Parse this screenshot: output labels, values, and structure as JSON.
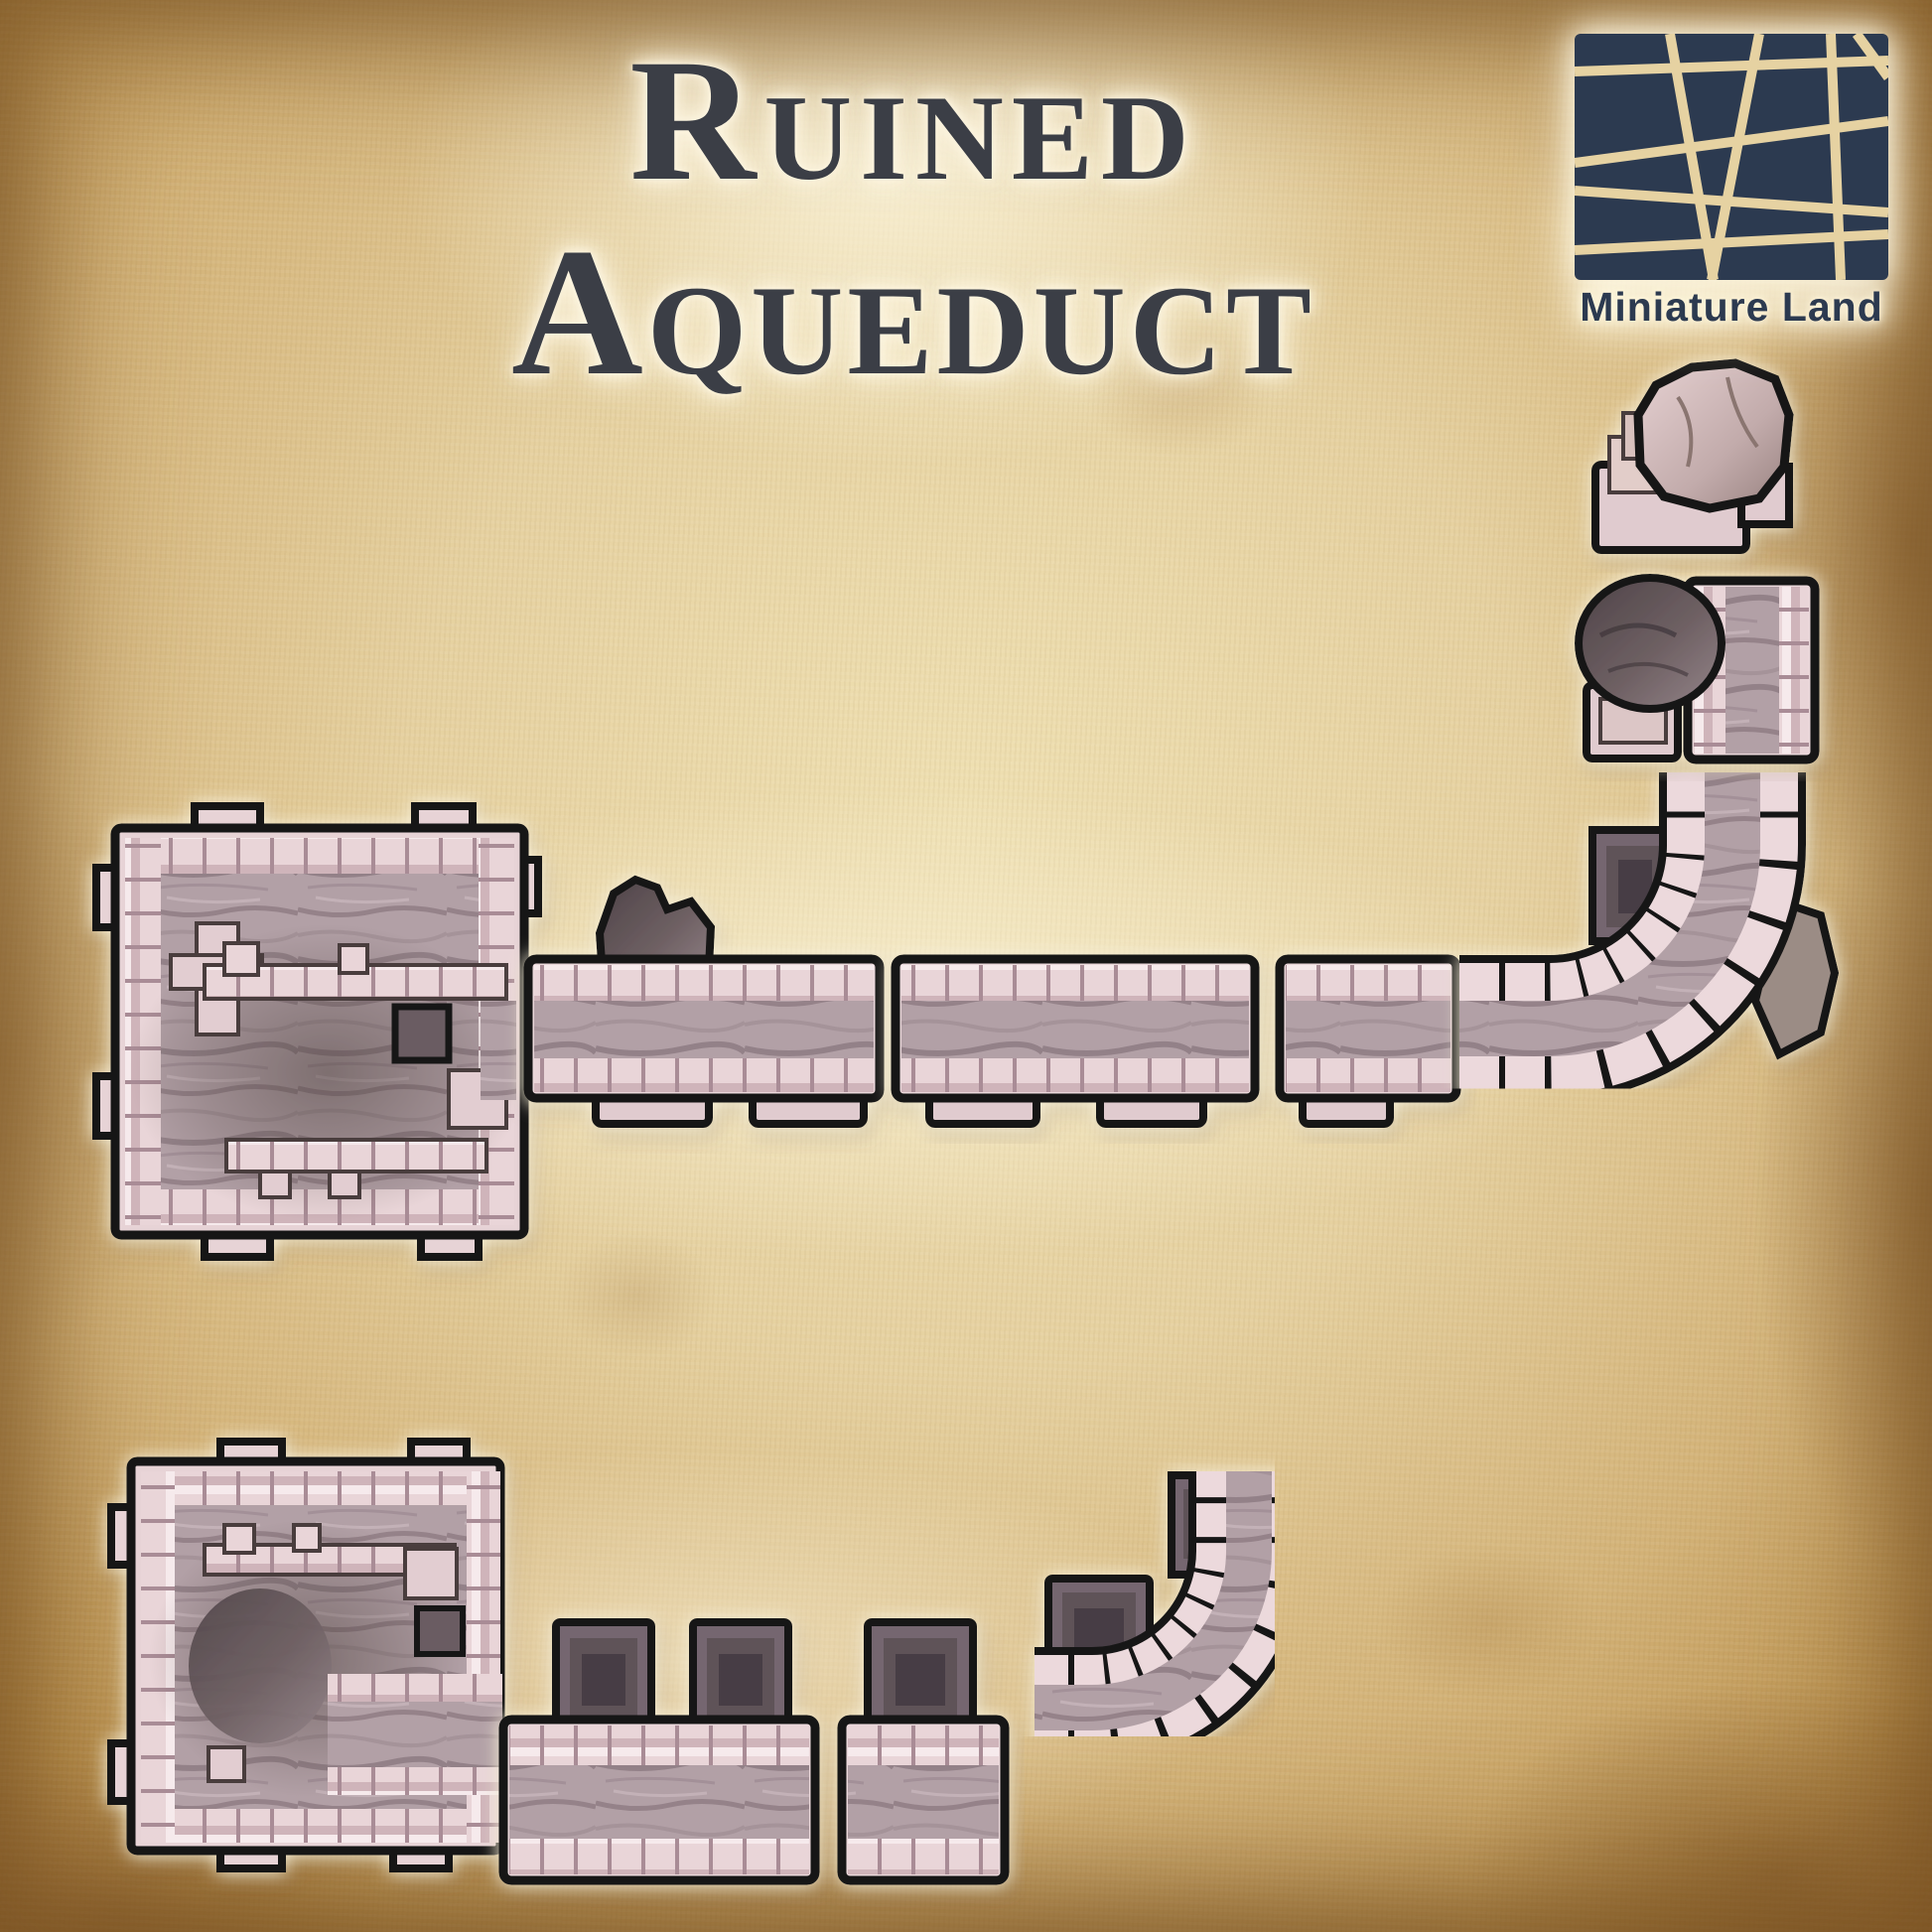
{
  "title": {
    "line1": "Ruined",
    "line2": "Aqueduct"
  },
  "logo": {
    "brand": "Miniature Land"
  },
  "colors": {
    "title-ink": "#3b3e46",
    "logo-navy": "#2c3a50",
    "logo-line": "#e6d2a2",
    "parchment-light": "#efe0b2",
    "parchment-dark": "#a87c41",
    "stone-pale": "#ecd9dc",
    "stone-joint": "#a98c96",
    "channel-gray": "#b2a0a6",
    "pier-dark": "#756670",
    "rock-dark": "#55494e",
    "outline-black": "#141414",
    "halo-white": "#fff8e0"
  },
  "pieces": [
    {
      "id": "tower-basin-1",
      "label": "ruined tower basin, top view"
    },
    {
      "id": "straight-segment-a",
      "label": "channel segment with rock debris"
    },
    {
      "id": "straight-segment-b",
      "label": "channel segment"
    },
    {
      "id": "straight-segment-c",
      "label": "short channel segment"
    },
    {
      "id": "corner-segment",
      "label": "curved corner channel with broken pillar"
    },
    {
      "id": "broken-channel-end",
      "label": "broken channel end with rocky dome"
    },
    {
      "id": "broken-pier",
      "label": "broken stepped pier"
    },
    {
      "id": "tower-basin-2",
      "label": "ruined tower basin, top view"
    },
    {
      "id": "ruined-segment-1",
      "label": "ruined channel segment with two piers"
    },
    {
      "id": "ruined-segment-2",
      "label": "ruined channel segment with pier"
    },
    {
      "id": "curve-segment-bottom",
      "label": "curved channel segment with piers"
    }
  ]
}
